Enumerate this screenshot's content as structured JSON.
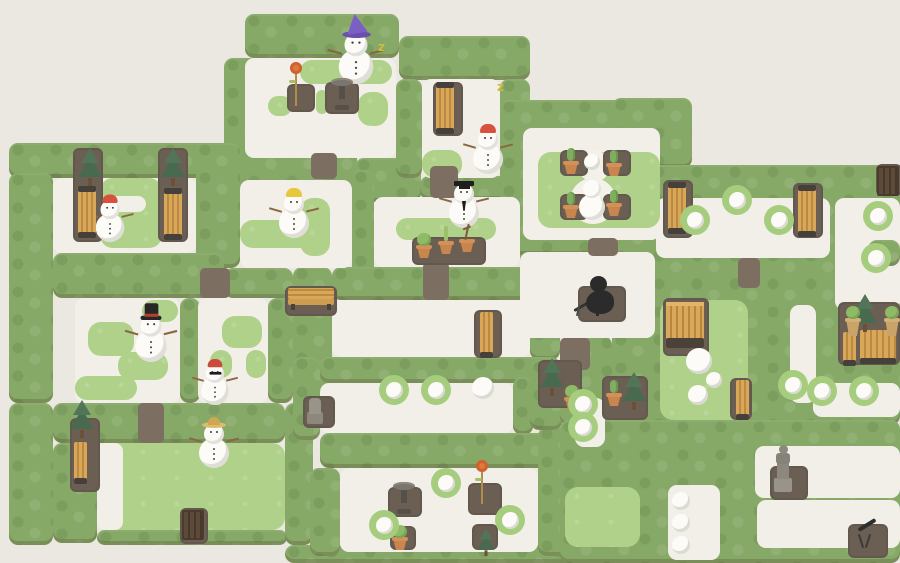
{
  "scene": {
    "width": 900,
    "height": 563
  },
  "palette": {
    "background": "#eae8e1",
    "hedge": "#87a968",
    "grass": "#afd189",
    "snow": "#f2efe8",
    "dirt_pad": "#6b5f54",
    "dirt_path": "#7c6e61",
    "bench_wood": "#d9a75a",
    "bench_wood_dark": "#bb8a40",
    "gate_wood": "#5d4a38",
    "terracotta": "#c8854e",
    "tree_green": "#486a4e",
    "melt_ring": "#a6cd7d",
    "snowball": "#fcfbf7",
    "monster": "#2b2b2b",
    "wizard_hat": "#7b5fc4",
    "red_cap": "#d8503e",
    "yellow_cap": "#e6c83d",
    "top_hat": "#262626",
    "straw_hat": "#dcbb70",
    "statue_gray": "#8d887e",
    "flower_orange": "#e0793a",
    "sleep_z": "#cdbb45"
  },
  "map": {
    "hedges": [
      [
        245,
        14,
        154,
        44
      ],
      [
        399,
        36,
        131,
        44
      ],
      [
        224,
        58,
        44,
        132
      ],
      [
        245,
        146,
        112,
        44
      ],
      [
        355,
        158,
        66,
        44
      ],
      [
        396,
        79,
        26,
        99
      ],
      [
        500,
        79,
        30,
        114
      ],
      [
        420,
        176,
        112,
        24
      ],
      [
        9,
        143,
        216,
        35
      ],
      [
        9,
        173,
        44,
        230
      ],
      [
        196,
        143,
        44,
        125
      ],
      [
        53,
        253,
        171,
        45
      ],
      [
        224,
        268,
        69,
        30
      ],
      [
        180,
        298,
        20,
        105
      ],
      [
        268,
        298,
        25,
        105
      ],
      [
        9,
        403,
        44,
        142
      ],
      [
        53,
        403,
        232,
        40
      ],
      [
        53,
        443,
        44,
        100
      ],
      [
        97,
        530,
        190,
        15
      ],
      [
        285,
        403,
        28,
        142
      ],
      [
        285,
        545,
        345,
        18
      ],
      [
        352,
        170,
        22,
        127
      ],
      [
        520,
        176,
        40,
        124
      ],
      [
        530,
        300,
        30,
        60
      ],
      [
        293,
        267,
        39,
        143
      ],
      [
        332,
        267,
        228,
        33
      ],
      [
        320,
        357,
        240,
        26
      ],
      [
        293,
        357,
        27,
        83
      ],
      [
        513,
        377,
        20,
        58
      ],
      [
        320,
        433,
        243,
        35
      ],
      [
        310,
        468,
        30,
        88
      ],
      [
        538,
        427,
        30,
        129
      ],
      [
        530,
        360,
        32,
        70
      ],
      [
        560,
        336,
        52,
        90
      ],
      [
        500,
        100,
        190,
        155
      ],
      [
        612,
        98,
        80,
        70
      ],
      [
        612,
        165,
        288,
        260
      ],
      [
        560,
        420,
        340,
        143
      ]
    ],
    "snow": [
      [
        245,
        58,
        151,
        100
      ],
      [
        422,
        79,
        78,
        99
      ],
      [
        523,
        128,
        137,
        112
      ],
      [
        53,
        178,
        143,
        75
      ],
      [
        240,
        180,
        112,
        88
      ],
      [
        374,
        197,
        146,
        70
      ],
      [
        656,
        198,
        174,
        60
      ],
      [
        835,
        198,
        65,
        112
      ],
      [
        520,
        252,
        135,
        86
      ],
      [
        75,
        298,
        105,
        105
      ],
      [
        198,
        298,
        70,
        105
      ],
      [
        320,
        383,
        193,
        50
      ],
      [
        575,
        398,
        30,
        49
      ],
      [
        340,
        468,
        198,
        84
      ],
      [
        790,
        305,
        26,
        98
      ],
      [
        813,
        383,
        87,
        34
      ],
      [
        755,
        446,
        145,
        52
      ],
      [
        757,
        500,
        143,
        48
      ],
      [
        668,
        485,
        52,
        75
      ],
      [
        332,
        300,
        198,
        57
      ]
    ],
    "grass": [
      [
        300,
        60,
        92,
        24
      ],
      [
        268,
        96,
        24,
        20
      ],
      [
        316,
        90,
        12,
        24
      ],
      [
        358,
        92,
        30,
        34
      ],
      [
        422,
        150,
        40,
        28
      ],
      [
        538,
        152,
        122,
        76
      ],
      [
        100,
        178,
        62,
        70
      ],
      [
        240,
        220,
        74,
        28
      ],
      [
        300,
        198,
        30,
        58
      ],
      [
        396,
        218,
        100,
        22
      ],
      [
        88,
        322,
        46,
        34
      ],
      [
        118,
        352,
        50,
        28
      ],
      [
        75,
        376,
        62,
        24
      ],
      [
        142,
        300,
        36,
        22
      ],
      [
        222,
        316,
        40,
        32
      ],
      [
        210,
        350,
        22,
        28
      ],
      [
        246,
        350,
        20,
        28
      ],
      [
        97,
        443,
        188,
        87
      ],
      [
        660,
        300,
        88,
        120
      ],
      [
        565,
        487,
        75,
        60
      ]
    ],
    "snowround": [
      [
        578,
        150,
        32
      ],
      [
        570,
        178,
        46
      ]
    ],
    "snow2": [
      [
        97,
        443,
        26,
        87
      ],
      [
        110,
        196,
        36,
        16
      ]
    ],
    "pads": [
      [
        287,
        84,
        28,
        28
      ],
      [
        325,
        82,
        34,
        32
      ],
      [
        433,
        82,
        30,
        54
      ],
      [
        73,
        148,
        30,
        94
      ],
      [
        158,
        148,
        30,
        94
      ],
      [
        560,
        150,
        28,
        26
      ],
      [
        603,
        150,
        28,
        26
      ],
      [
        560,
        194,
        28,
        26
      ],
      [
        603,
        194,
        28,
        26
      ],
      [
        412,
        237,
        74,
        28
      ],
      [
        285,
        286,
        52,
        30
      ],
      [
        578,
        286,
        48,
        36
      ],
      [
        663,
        180,
        30,
        58
      ],
      [
        793,
        183,
        30,
        55
      ],
      [
        663,
        298,
        46,
        58
      ],
      [
        730,
        378,
        22,
        42
      ],
      [
        838,
        302,
        62,
        63
      ],
      [
        602,
        376,
        46,
        44
      ],
      [
        538,
        360,
        44,
        48
      ],
      [
        303,
        396,
        32,
        32
      ],
      [
        388,
        487,
        34,
        30
      ],
      [
        468,
        483,
        34,
        32
      ],
      [
        390,
        526,
        26,
        24
      ],
      [
        472,
        524,
        26,
        26
      ],
      [
        770,
        466,
        38,
        34
      ],
      [
        848,
        524,
        40,
        34
      ],
      [
        70,
        418,
        30,
        74
      ],
      [
        876,
        164,
        26,
        32
      ],
      [
        180,
        508,
        28,
        36
      ],
      [
        474,
        310,
        28,
        48
      ]
    ],
    "paths": [
      [
        430,
        166,
        28,
        32
      ],
      [
        588,
        238,
        30,
        18
      ],
      [
        738,
        258,
        22,
        30
      ],
      [
        560,
        338,
        30,
        32
      ],
      [
        138,
        403,
        26,
        40
      ],
      [
        423,
        262,
        26,
        38
      ],
      [
        200,
        268,
        30,
        30
      ],
      [
        311,
        153,
        26,
        26
      ]
    ],
    "hedgetop": [
      [
        868,
        240,
        32,
        26
      ]
    ]
  },
  "entities": [
    {
      "t": "snowman",
      "hat": "wizard",
      "x": 338,
      "y": 32,
      "s": 1.15
    },
    {
      "t": "snowman",
      "hat": "red",
      "x": 470,
      "y": 122
    },
    {
      "t": "snowman",
      "hat": "yellow",
      "x": 276,
      "y": 186
    },
    {
      "t": "snowman",
      "hat": "grad",
      "x": 446,
      "y": 176
    },
    {
      "t": "snowman",
      "hat": "red",
      "x": 92,
      "y": 190,
      "s": 0.95
    },
    {
      "t": "snowman",
      "hat": "top",
      "x": 133,
      "y": 310,
      "s": 1.05
    },
    {
      "t": "snowman",
      "hat": "beanie",
      "x": 197,
      "y": 353,
      "s": 0.92
    },
    {
      "t": "snowman",
      "hat": "straw",
      "x": 196,
      "y": 416
    },
    {
      "t": "snowstack",
      "x": 577,
      "y": 176
    },
    {
      "t": "monster",
      "x": 578,
      "y": 276
    },
    {
      "t": "zzz",
      "x": 378,
      "y": 40,
      "ch": "z"
    },
    {
      "t": "zzz",
      "x": 497,
      "y": 80,
      "ch": "z"
    },
    {
      "t": "benchv",
      "x": 436,
      "y": 84
    },
    {
      "t": "benchv",
      "x": 78,
      "y": 188
    },
    {
      "t": "benchv",
      "x": 164,
      "y": 190
    },
    {
      "t": "benchv",
      "x": 668,
      "y": 184
    },
    {
      "t": "benchv",
      "x": 798,
      "y": 187
    },
    {
      "t": "benchh",
      "x": 288,
      "y": 288
    },
    {
      "t": "benchfront",
      "x": 666,
      "y": 302
    },
    {
      "t": "fence",
      "x": 480,
      "y": 312,
      "h": 44
    },
    {
      "t": "fence",
      "x": 736,
      "y": 380,
      "h": 38
    },
    {
      "t": "fence",
      "x": 74,
      "y": 442,
      "h": 40
    },
    {
      "t": "fence",
      "x": 843,
      "y": 332,
      "h": 32
    },
    {
      "t": "fencewide",
      "x": 860,
      "y": 330
    },
    {
      "t": "gate",
      "x": 877,
      "y": 166
    },
    {
      "t": "gate",
      "x": 182,
      "y": 510
    },
    {
      "t": "tree",
      "x": 78,
      "y": 148
    },
    {
      "t": "tree",
      "x": 161,
      "y": 148
    },
    {
      "t": "tree",
      "x": 70,
      "y": 400
    },
    {
      "t": "tree",
      "x": 540,
      "y": 358
    },
    {
      "t": "tree",
      "x": 622,
      "y": 372
    },
    {
      "t": "tree",
      "x": 853,
      "y": 294
    },
    {
      "t": "tree",
      "x": 474,
      "y": 518,
      "s": 0.72
    },
    {
      "t": "potcactus",
      "x": 563,
      "y": 146
    },
    {
      "t": "potcactus",
      "x": 606,
      "y": 148
    },
    {
      "t": "potcactus",
      "x": 563,
      "y": 190
    },
    {
      "t": "potcactus",
      "x": 606,
      "y": 188
    },
    {
      "t": "potcactus",
      "x": 606,
      "y": 378
    },
    {
      "t": "potplant",
      "x": 392,
      "y": 522
    },
    {
      "t": "potplant",
      "x": 564,
      "y": 382
    },
    {
      "t": "potshrub",
      "x": 416,
      "y": 230
    },
    {
      "t": "potsprout",
      "x": 438,
      "y": 226
    },
    {
      "t": "pottwig",
      "x": 459,
      "y": 224
    },
    {
      "t": "topiary",
      "x": 845,
      "y": 302
    },
    {
      "t": "topiary",
      "x": 884,
      "y": 302
    },
    {
      "t": "flower",
      "x": 288,
      "y": 62
    },
    {
      "t": "flower",
      "x": 474,
      "y": 460
    },
    {
      "t": "birdbath",
      "x": 330,
      "y": 78
    },
    {
      "t": "birdbath",
      "x": 392,
      "y": 482
    },
    {
      "t": "statuesm",
      "x": 306,
      "y": 394
    },
    {
      "t": "statue",
      "x": 772,
      "y": 442
    },
    {
      "t": "telescope",
      "x": 850,
      "y": 520
    },
    {
      "t": "ball",
      "x": 686,
      "y": 348,
      "r": 13
    },
    {
      "t": "ball",
      "x": 706,
      "y": 372,
      "r": 8
    },
    {
      "t": "ball",
      "x": 688,
      "y": 385,
      "r": 10
    },
    {
      "t": "ball",
      "x": 584,
      "y": 154,
      "r": 8
    },
    {
      "t": "ball",
      "x": 472,
      "y": 377,
      "r": 11
    },
    {
      "t": "ball",
      "x": 672,
      "y": 492,
      "r": 9
    },
    {
      "t": "ball",
      "x": 672,
      "y": 514,
      "r": 9
    },
    {
      "t": "ball",
      "x": 672,
      "y": 536,
      "r": 9
    },
    {
      "t": "ringball",
      "x": 680,
      "y": 205
    },
    {
      "t": "ringball",
      "x": 722,
      "y": 185
    },
    {
      "t": "ringball",
      "x": 764,
      "y": 205
    },
    {
      "t": "ringball",
      "x": 863,
      "y": 201
    },
    {
      "t": "ringball",
      "x": 861,
      "y": 243
    },
    {
      "t": "ringball",
      "x": 379,
      "y": 375
    },
    {
      "t": "ringball",
      "x": 421,
      "y": 375
    },
    {
      "t": "ringball",
      "x": 568,
      "y": 389
    },
    {
      "t": "ringball",
      "x": 568,
      "y": 412
    },
    {
      "t": "ringball",
      "x": 431,
      "y": 468
    },
    {
      "t": "ringball",
      "x": 369,
      "y": 510
    },
    {
      "t": "ringball",
      "x": 495,
      "y": 505
    },
    {
      "t": "ringball",
      "x": 778,
      "y": 370
    },
    {
      "t": "ringball",
      "x": 807,
      "y": 376
    },
    {
      "t": "ringball",
      "x": 849,
      "y": 376
    }
  ]
}
